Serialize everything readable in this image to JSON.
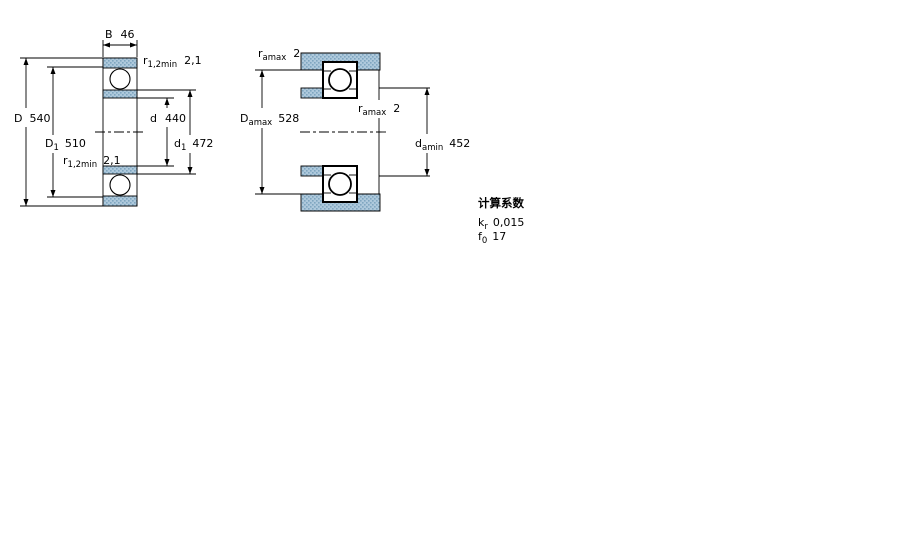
{
  "colors": {
    "hatch_bg": "#aec9dc",
    "hatch_dot": "#7fa6c0",
    "line": "#000000",
    "background": "#ffffff"
  },
  "left_figure": {
    "dim_B": {
      "sym": "B",
      "sub": "",
      "value": "46"
    },
    "dim_D": {
      "sym": "D",
      "sub": "",
      "value": "540"
    },
    "dim_D1": {
      "sym": "D",
      "sub": "1",
      "value": "510"
    },
    "dim_d": {
      "sym": "d",
      "sub": "",
      "value": "440"
    },
    "dim_d1": {
      "sym": "d",
      "sub": "1",
      "value": "472"
    },
    "dim_r_top": {
      "sym": "r",
      "sub": "1,2min",
      "value": "2,1"
    },
    "dim_r_bottom": {
      "sym": "r",
      "sub": "1,2min",
      "value": "2,1"
    }
  },
  "right_figure": {
    "dim_ra_top": {
      "sym": "r",
      "sub": "amax",
      "value": "2"
    },
    "dim_ra_mid": {
      "sym": "r",
      "sub": "amax",
      "value": "2"
    },
    "dim_Da": {
      "sym": "D",
      "sub": "amax",
      "value": "528"
    },
    "dim_da": {
      "sym": "d",
      "sub": "amin",
      "value": "452"
    }
  },
  "calculation_factors": {
    "title": "计算系数",
    "rows": [
      {
        "sym": "k",
        "sub": "r",
        "value": "0,015"
      },
      {
        "sym": "f",
        "sub": "0",
        "value": "17"
      }
    ]
  }
}
